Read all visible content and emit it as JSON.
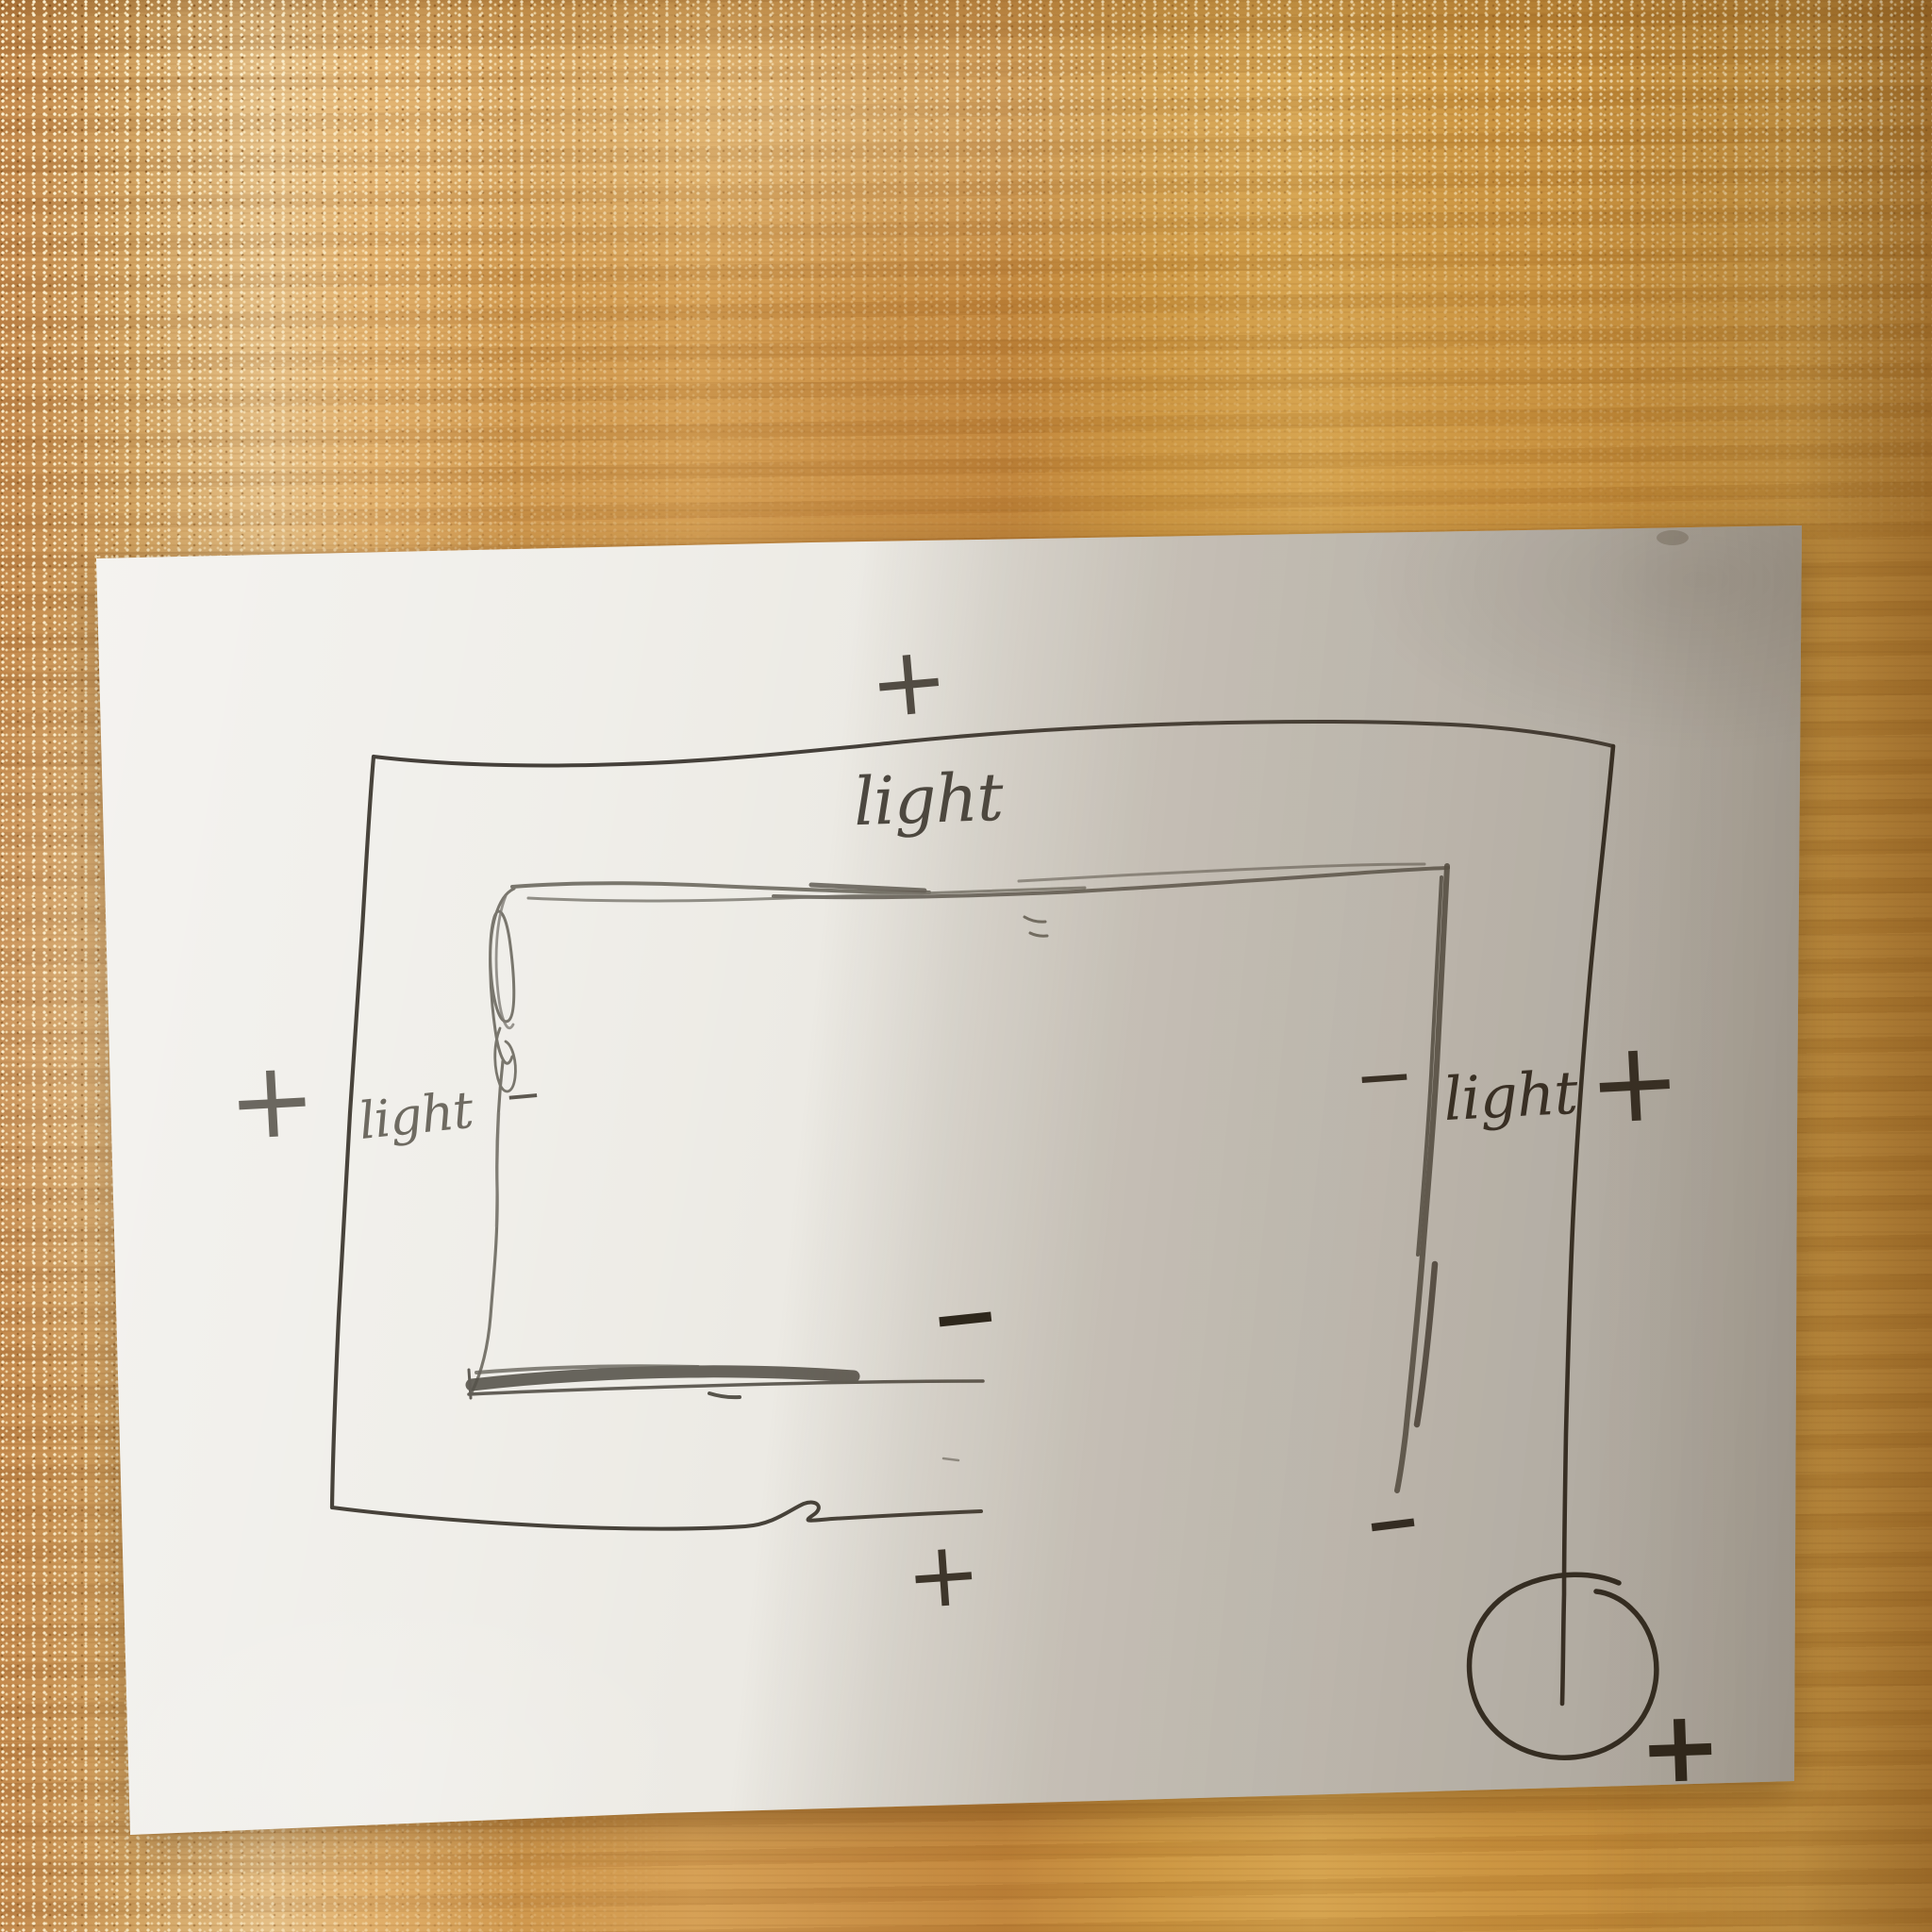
{
  "scene": {
    "type": "photograph of a hand-drawn electrical sketch",
    "surface": "wooden desk",
    "medium": "pen and pencil on white paper"
  },
  "sketch": {
    "labels": [
      {
        "id": "light-top",
        "text": "light",
        "position": "top center, inside outer loop"
      },
      {
        "id": "light-left",
        "text": "light",
        "position": "left side, between outer and inner loop"
      },
      {
        "id": "light-right",
        "text": "light",
        "position": "right side, between inner line and outer wire"
      }
    ],
    "signs": [
      {
        "id": "plus-top-center",
        "text": "+",
        "position": "above outer loop, top center"
      },
      {
        "id": "plus-left-outer",
        "text": "+",
        "position": "left of outer loop"
      },
      {
        "id": "minus-left-inner",
        "text": "−",
        "position": "right of left light label"
      },
      {
        "id": "minus-right-inner",
        "text": "−",
        "position": "left of right light label"
      },
      {
        "id": "plus-right-outer",
        "text": "+",
        "position": "right of outer wire"
      },
      {
        "id": "minus-center",
        "text": "−",
        "position": "center, above inner loop bottom edge"
      },
      {
        "id": "minus-bottom-right",
        "text": "−",
        "position": "below inner right line"
      },
      {
        "id": "plus-bottom-center",
        "text": "+",
        "position": "below outer loop bottom edge"
      },
      {
        "id": "plus-bottom-right",
        "text": "+",
        "position": "beside circle, bottom right"
      }
    ],
    "shapes": [
      "outer pen wire loop (open at bottom right)",
      "inner pencil loop with scribbled corner and heavy bottom edge",
      "right pen wire descending into a drawn circle (battery/bulb)"
    ]
  },
  "colors": {
    "wood_base": "#c8913f",
    "paper_light": "#eceae4",
    "paper_shadow": "#a89f8e",
    "pen_ink": "#332d25",
    "pencil": "#6f6b62"
  }
}
